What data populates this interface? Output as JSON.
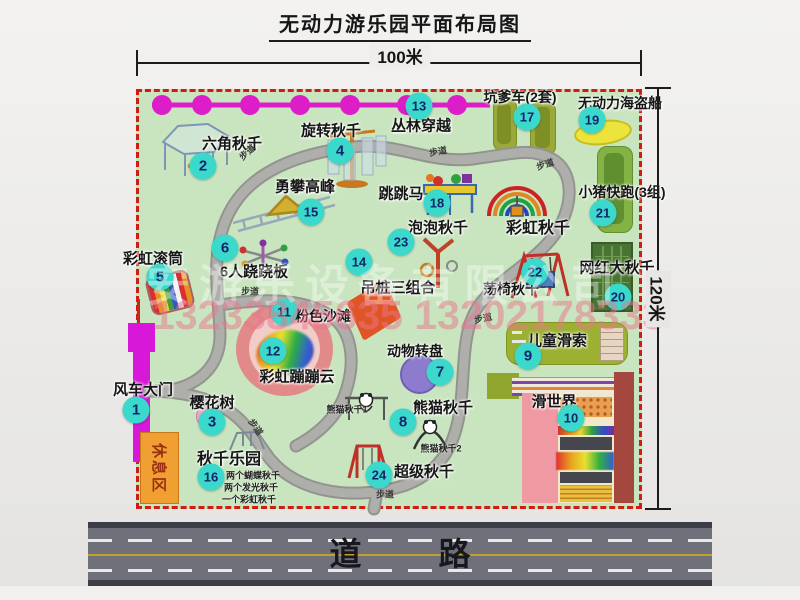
{
  "title": "无动力游乐园平面布局图",
  "dim_top": "100米",
  "dim_right": "120米",
  "road": {
    "label": "道  路"
  },
  "watermark": {
    "company": "安游乐设备有限公司",
    "phones": "13233845635 13202178333"
  },
  "map": {
    "path_label": "步道",
    "rest_area_label": "休息区",
    "rainbow_swing_label": "彩虹秋千",
    "panda_sub1": "熊猫秋千1",
    "panda_sub2": "熊猫秋千2",
    "swing_park_notes": [
      "两个蝴蝶秋千",
      "两个发光秋千",
      "一个彩虹秋千"
    ],
    "attractions": [
      {
        "num": "1",
        "label": "风车大门"
      },
      {
        "num": "2",
        "label": "六角秋千"
      },
      {
        "num": "3",
        "label": "樱花树"
      },
      {
        "num": "4",
        "label": "旋转秋千"
      },
      {
        "num": "5",
        "label": "彩虹滚筒"
      },
      {
        "num": "6",
        "label": "6人跷跷板"
      },
      {
        "num": "7",
        "label": "动物转盘"
      },
      {
        "num": "8",
        "label": "熊猫秋千"
      },
      {
        "num": "9",
        "label": "儿童滑索"
      },
      {
        "num": "10",
        "label": "滑世界"
      },
      {
        "num": "11",
        "label": "粉色沙滩"
      },
      {
        "num": "12",
        "label": "彩虹蹦蹦云"
      },
      {
        "num": "13",
        "label": "丛林穿越"
      },
      {
        "num": "14",
        "label": "吊桩三组合"
      },
      {
        "num": "15",
        "label": "勇攀高峰"
      },
      {
        "num": "16",
        "label": "秋千乐园"
      },
      {
        "num": "17",
        "label": "坑爹车(2套)"
      },
      {
        "num": "18",
        "label": "跳跳马"
      },
      {
        "num": "19",
        "label": "无动力海盗船"
      },
      {
        "num": "20",
        "label": "网红大秋千"
      },
      {
        "num": "21",
        "label": "小猪快跑(3组)"
      },
      {
        "num": "22",
        "label": "荡椅秋千"
      },
      {
        "num": "23",
        "label": "泡泡秋千"
      },
      {
        "num": "24",
        "label": "超级秋千"
      }
    ],
    "colors": {
      "badge": "#3bd8cc",
      "border_red": "#cf1d15",
      "grass": "#c9e5bf",
      "walkway": "#a9a9a6",
      "chain_magenta": "#dd1ec8",
      "gate_magenta": "#d818d8"
    }
  }
}
